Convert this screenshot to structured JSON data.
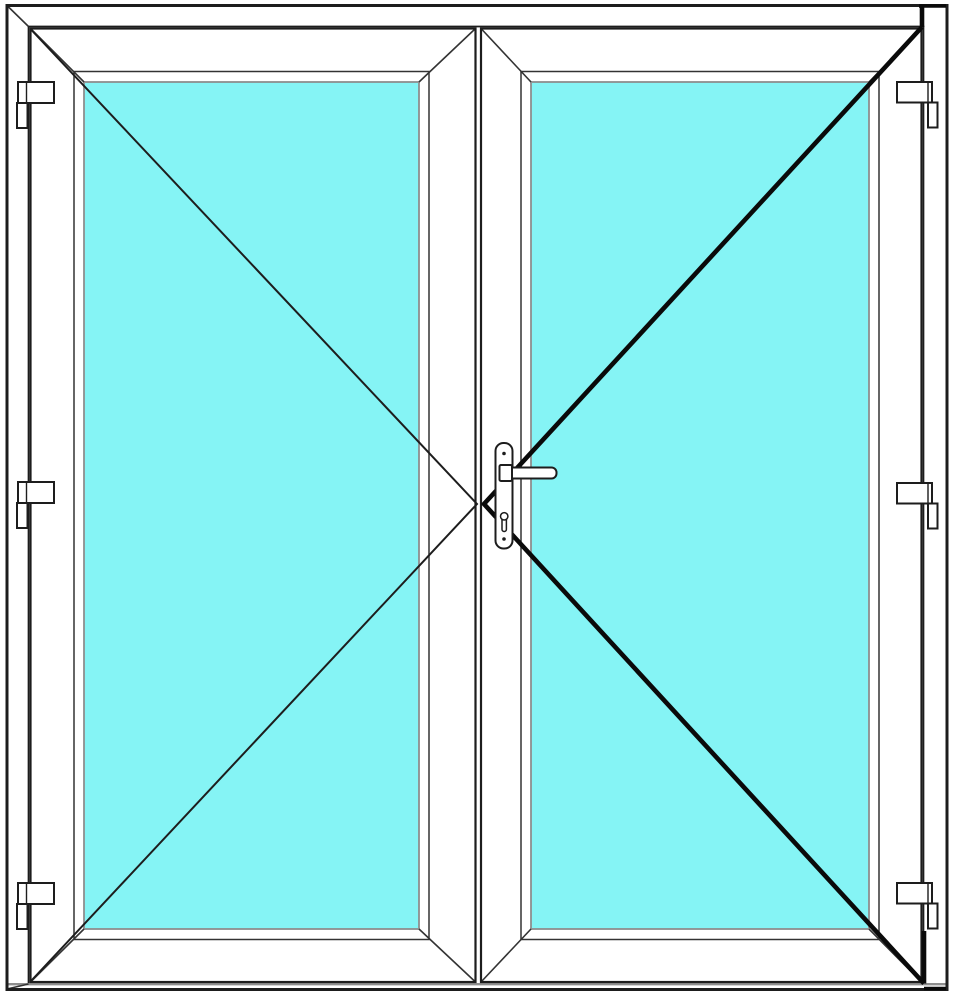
{
  "page": {
    "kind": "product-technical-drawing",
    "subject": "Double-leaf entrance door with full glazing, front view"
  },
  "drawing": {
    "colors": {
      "background": "#ffffff",
      "surface": "#ffffff",
      "line": "#1d1d1d",
      "line_soft": "#333333",
      "line_gray": "#8e8e8e",
      "glass": "#85f4f5",
      "opening_thick": "#0a0a0a"
    },
    "frame": {
      "name": "outer frame",
      "threshold": "bottom threshold"
    },
    "leaves": [
      {
        "name": "left door leaf",
        "hinge_side": "left",
        "hinge_count": 3,
        "opening_line": "thin",
        "glazing": "glass pane"
      },
      {
        "name": "right door leaf (active leaf)",
        "hinge_side": "right",
        "hinge_count": 3,
        "opening_line": "thick",
        "glazing": "glass pane",
        "hardware": {
          "handle": "lever handle",
          "backplate": "long security backplate",
          "keyhole": "cylinder keyhole",
          "screws": 2
        }
      }
    ]
  }
}
